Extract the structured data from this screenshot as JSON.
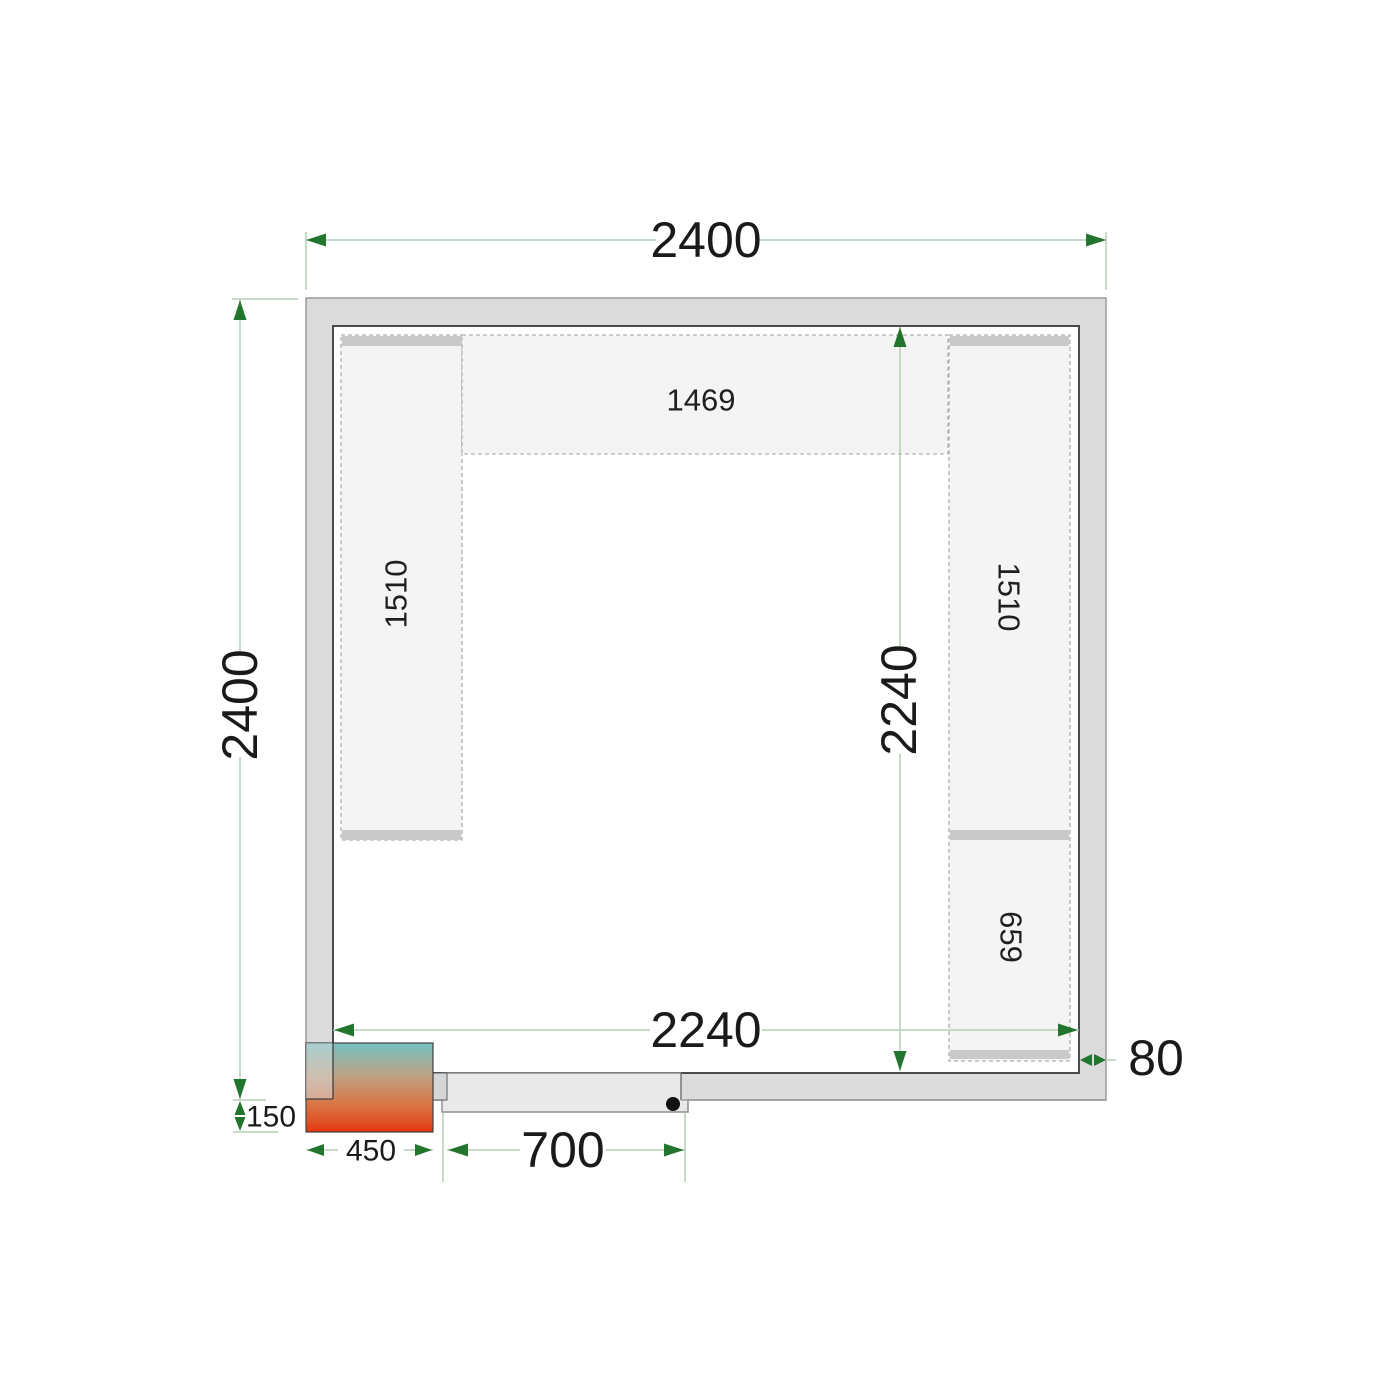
{
  "diagram": {
    "type": "cold-room-floor-plan",
    "room": {
      "outer_width_label": "2400",
      "outer_depth_label": "2400",
      "inner_width_label": "2240",
      "inner_depth_label": "2240",
      "wall_thickness_label": "80"
    },
    "door": {
      "opening_width_label": "700"
    },
    "cooling_unit": {
      "width_label": "450",
      "protrusion_label": "150"
    },
    "shelves": {
      "top_label": "1469",
      "left_label": "1510",
      "right_upper_label": "1510",
      "right_lower_label": "659"
    },
    "colors": {
      "dimension_line": "#b5cfb7",
      "dimension_arrow": "#21752c",
      "wall_fill": "#dbdbdb",
      "wall_outline": "#9a9a9a",
      "room_outline": "#4a4a4a",
      "shelf_fill": "#f4f4f4",
      "shelf_bar": "#c9c9c9",
      "door_leaf_fill": "#e9e9e9",
      "unit_gradient_top": "#76c1c3",
      "unit_gradient_bottom": "#e5330f",
      "label_text": "#1a1a1a"
    }
  }
}
